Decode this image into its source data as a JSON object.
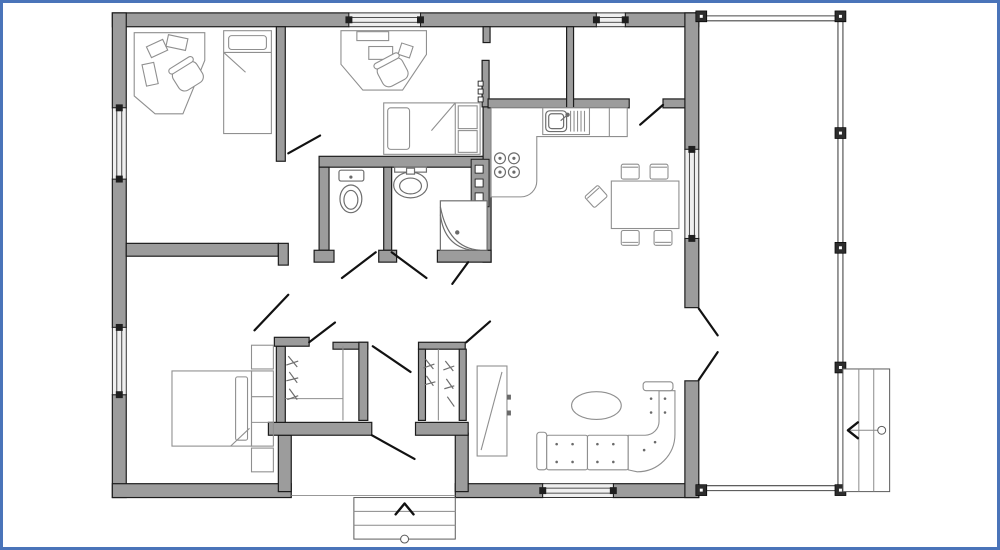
{
  "colors": {
    "paper": "#ffffff",
    "frame": "#4a74b9",
    "wall": "#9c9c9c",
    "stroke": "#1c1c1c",
    "furniture": "#8f8f8f",
    "fixture": "#6e6e6e",
    "door": "#121212",
    "porch": "#474747",
    "window": "#efefef",
    "post": "#2d2d2d"
  },
  "legend": {
    "plan": "floor-plan",
    "office": "office-room",
    "bedroom_small": "small-bedroom",
    "bedroom_master": "master-bedroom",
    "wc": "wc",
    "bathroom": "bathroom",
    "kitchen": "kitchen",
    "dining": "dining-area",
    "living": "living-room",
    "hall": "entry-hall",
    "closets": "wardrobe-closets",
    "storage": "storage-rooms",
    "porch": "porch-veranda",
    "entry_steps": "entry-steps",
    "porch_steps": "porch-steps"
  }
}
